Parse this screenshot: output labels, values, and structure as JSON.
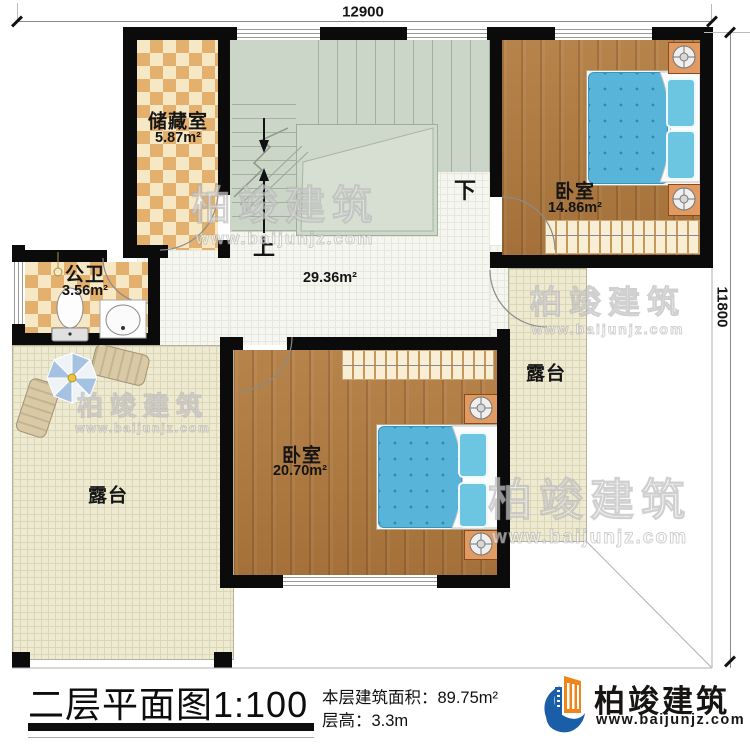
{
  "dimensions": {
    "top": "12900",
    "right": "11800"
  },
  "stairs": {
    "up": "上",
    "down": "下"
  },
  "rooms": {
    "storage": {
      "name": "储藏室",
      "area": "5.87m²"
    },
    "bathroom": {
      "name": "公卫",
      "area": "3.56m²"
    },
    "bedroom1": {
      "name": "卧室",
      "area": "14.86m²"
    },
    "bedroom2": {
      "name": "卧室",
      "area": "20.70m²"
    },
    "hall": {
      "area": "29.36m²"
    },
    "terrace_left": {
      "name": "露台"
    },
    "terrace_right": {
      "name": "露台"
    }
  },
  "footer": {
    "title": "二层平面图",
    "scale": "1:100",
    "floor_area_label": "本层建筑面积：",
    "floor_area_value": "89.75m²",
    "floor_height_label": "层高：",
    "floor_height_value": "3.3m"
  },
  "logo": {
    "name": "柏竣建筑",
    "website": "www.baijunjz.com"
  },
  "watermark": {
    "line1": "柏竣建筑",
    "line2": "www.baijunjz.com"
  },
  "colors": {
    "wall": "#0b0b0b",
    "wood": "#b17a3e",
    "stair": "#ccd6c8",
    "terrace_tile": "#eeead2",
    "checker_tile": "#e3b06e",
    "bed": "#58b4d8",
    "logo_blue": "#1a5ea8",
    "logo_orange": "#f0851c"
  }
}
